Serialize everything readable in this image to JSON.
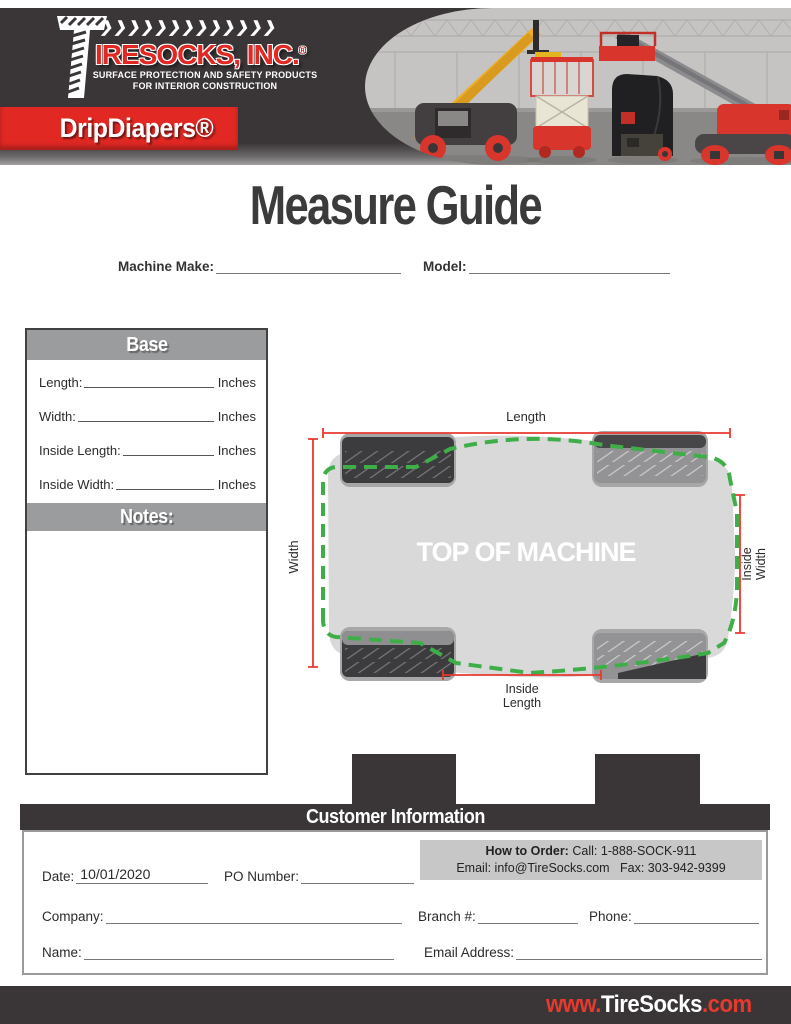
{
  "header": {
    "logo": {
      "chevrons": "❯❯❯❯❯❯❯❯❯❯❯❯❯",
      "brand": "IRESOCKS, INC.",
      "registered": "®",
      "tagline_line1": "SURFACE PROTECTION AND SAFETY PRODUCTS",
      "tagline_line2": "FOR INTERIOR CONSTRUCTION"
    },
    "product_banner": "DripDiapers®"
  },
  "title": "Measure Guide",
  "machine_row": {
    "make_label": "Machine Make:",
    "model_label": "Model:"
  },
  "base_section": {
    "title": "Base",
    "fields": [
      {
        "label": "Length:",
        "unit": "Inches"
      },
      {
        "label": "Width:",
        "unit": "Inches"
      },
      {
        "label": "Inside Length:",
        "unit": "Inches"
      },
      {
        "label": "Inside Width:",
        "unit": "Inches"
      }
    ],
    "notes_title": "Notes:"
  },
  "diagram": {
    "center_label": "TOP OF MACHINE",
    "length_label": "Length",
    "width_label": "Width",
    "inside_width_line1": "Inside",
    "inside_width_line2": "Width",
    "inside_length_line1": "Inside",
    "inside_length_line2": "Length"
  },
  "customer_info": {
    "title": "Customer Information",
    "how_to_order": {
      "heading": "How to Order:",
      "call": "Call: 1-888-SOCK-911",
      "email": "Email: info@TireSocks.com",
      "fax": "Fax: 303-942-9399"
    },
    "date_label": "Date:",
    "date_value": "10/01/2020",
    "po_label": "PO Number:",
    "company_label": "Company:",
    "branch_label": "Branch #:",
    "phone_label": "Phone:",
    "name_label": "Name:",
    "email_label": "Email Address:"
  },
  "footer": {
    "www": "www.",
    "domain": "TireSocks",
    "tld": ".com"
  },
  "colors": {
    "brand_red": "#e12823",
    "charcoal": "#3a3637",
    "section_gray": "#9b9c9e",
    "dimension_red": "#e8392e",
    "diaper_green": "#3fae49",
    "machine_body_gray": "#d9d9d9",
    "order_box_gray": "#c7c7c7"
  }
}
